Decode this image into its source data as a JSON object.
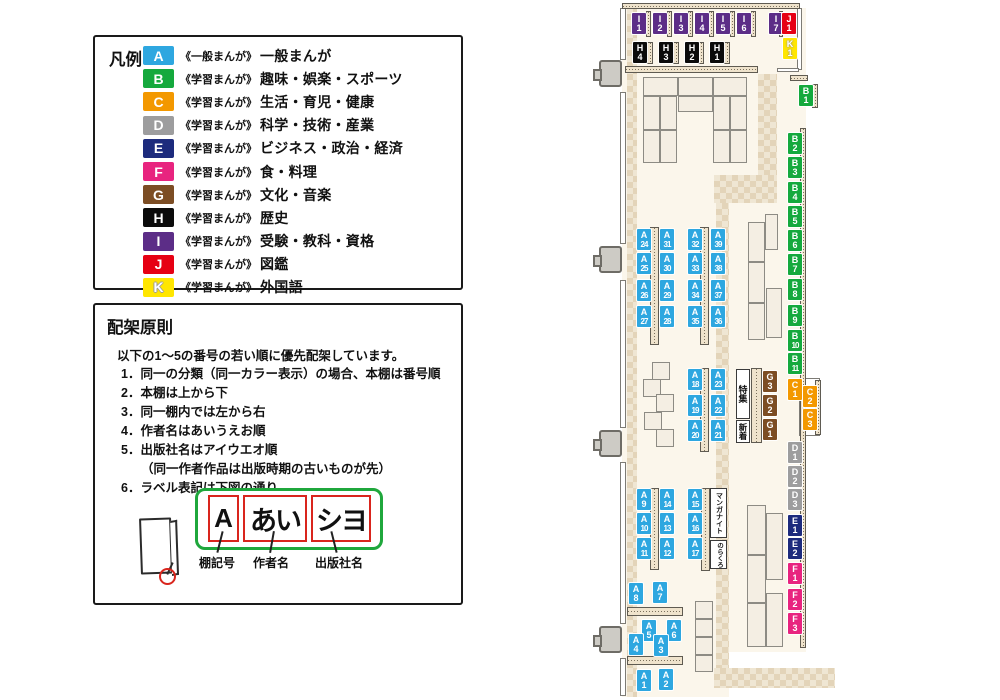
{
  "category_colors": {
    "A": "#2EA7E0",
    "B": "#15A93D",
    "C": "#F39800",
    "D": "#9D9D9E",
    "E": "#1D2B7D",
    "F": "#E8247F",
    "G": "#7C4D24",
    "H": "#0B0B0B",
    "I": "#5C2D87",
    "J": "#E60013",
    "K": "#FFE600"
  },
  "legend": {
    "title": "凡例",
    "items": [
      {
        "code": "A",
        "series": "《一般まんが》",
        "category": "一般まんが"
      },
      {
        "code": "B",
        "series": "《学習まんが》",
        "category": "趣味・娯楽・スポーツ"
      },
      {
        "code": "C",
        "series": "《学習まんが》",
        "category": "生活・育児・健康"
      },
      {
        "code": "D",
        "series": "《学習まんが》",
        "category": "科学・技術・産業"
      },
      {
        "code": "E",
        "series": "《学習まんが》",
        "category": "ビジネス・政治・経済"
      },
      {
        "code": "F",
        "series": "《学習まんが》",
        "category": "食・料理"
      },
      {
        "code": "G",
        "series": "《学習まんが》",
        "category": "文化・音楽"
      },
      {
        "code": "H",
        "series": "《学習まんが》",
        "category": "歴史"
      },
      {
        "code": "I",
        "series": "《学習まんが》",
        "category": "受験・教科・資格"
      },
      {
        "code": "J",
        "series": "《学習まんが》",
        "category": "図鑑"
      },
      {
        "code": "K",
        "series": "《学習まんが》",
        "category": "外国語"
      }
    ]
  },
  "principles": {
    "title": "配架原則",
    "intro": "以下の1～5の番号の若い順に優先配架しています。",
    "items": [
      "1．同一の分類（同一カラー表示）の場合、本棚は番号順",
      "2．本棚は上から下",
      "3．同一棚内では左から右",
      "4．作者名はあいうえお順",
      "5．出版社名はアイウエオ順",
      "（同一作者作品は出版時期の古いものが先）",
      "6．ラベル表記は下図の通り"
    ],
    "label_diagram": {
      "segments": [
        {
          "text": "A",
          "caption": "棚記号"
        },
        {
          "text": "あい",
          "caption": "作者名"
        },
        {
          "text": "シヨ",
          "caption": "出版社名"
        }
      ]
    }
  },
  "map": {
    "feature_boxes": [
      {
        "text": "特集",
        "x": 736,
        "y": 369,
        "w": 14,
        "h": 50
      },
      {
        "text": "新着",
        "x": 736,
        "y": 420,
        "w": 14,
        "h": 23
      },
      {
        "text": "マンガナイト",
        "x": 710,
        "y": 488,
        "w": 17,
        "h": 50
      },
      {
        "text": "のらくろ",
        "x": 710,
        "y": 540,
        "w": 17,
        "h": 29
      }
    ],
    "shelf_labels": [
      {
        "id": "I1",
        "x": 632,
        "y": 13
      },
      {
        "id": "I2",
        "x": 653,
        "y": 13
      },
      {
        "id": "I3",
        "x": 674,
        "y": 13
      },
      {
        "id": "I4",
        "x": 695,
        "y": 13
      },
      {
        "id": "I5",
        "x": 716,
        "y": 13
      },
      {
        "id": "I6",
        "x": 737,
        "y": 13
      },
      {
        "id": "I7",
        "x": 769,
        "y": 13
      },
      {
        "id": "J1",
        "x": 782,
        "y": 13
      },
      {
        "id": "K1",
        "x": 783,
        "y": 38
      },
      {
        "id": "H4",
        "x": 633,
        "y": 42
      },
      {
        "id": "H3",
        "x": 659,
        "y": 42
      },
      {
        "id": "H2",
        "x": 685,
        "y": 42
      },
      {
        "id": "H1",
        "x": 710,
        "y": 42
      },
      {
        "id": "B1",
        "x": 799,
        "y": 85
      },
      {
        "id": "B2",
        "x": 788,
        "y": 133
      },
      {
        "id": "B3",
        "x": 788,
        "y": 157
      },
      {
        "id": "B4",
        "x": 788,
        "y": 182
      },
      {
        "id": "B5",
        "x": 788,
        "y": 206
      },
      {
        "id": "B6",
        "x": 788,
        "y": 230
      },
      {
        "id": "B7",
        "x": 788,
        "y": 254
      },
      {
        "id": "B8",
        "x": 788,
        "y": 279
      },
      {
        "id": "B9",
        "x": 788,
        "y": 305
      },
      {
        "id": "B10",
        "x": 788,
        "y": 330
      },
      {
        "id": "B11",
        "x": 788,
        "y": 353
      },
      {
        "id": "C1",
        "x": 788,
        "y": 379
      },
      {
        "id": "C2",
        "x": 803,
        "y": 386
      },
      {
        "id": "C3",
        "x": 803,
        "y": 409
      },
      {
        "id": "D1",
        "x": 788,
        "y": 442
      },
      {
        "id": "D2",
        "x": 788,
        "y": 466
      },
      {
        "id": "D3",
        "x": 788,
        "y": 489
      },
      {
        "id": "E1",
        "x": 788,
        "y": 515
      },
      {
        "id": "E2",
        "x": 788,
        "y": 538
      },
      {
        "id": "F1",
        "x": 788,
        "y": 563
      },
      {
        "id": "F2",
        "x": 788,
        "y": 589
      },
      {
        "id": "F3",
        "x": 788,
        "y": 613
      },
      {
        "id": "G3",
        "x": 763,
        "y": 371
      },
      {
        "id": "G2",
        "x": 763,
        "y": 395
      },
      {
        "id": "G1",
        "x": 763,
        "y": 419
      },
      {
        "id": "A24",
        "x": 637,
        "y": 229
      },
      {
        "id": "A25",
        "x": 637,
        "y": 253
      },
      {
        "id": "A26",
        "x": 637,
        "y": 280
      },
      {
        "id": "A27",
        "x": 637,
        "y": 306
      },
      {
        "id": "A31",
        "x": 660,
        "y": 229
      },
      {
        "id": "A30",
        "x": 660,
        "y": 253
      },
      {
        "id": "A29",
        "x": 660,
        "y": 280
      },
      {
        "id": "A28",
        "x": 660,
        "y": 306
      },
      {
        "id": "A32",
        "x": 688,
        "y": 229
      },
      {
        "id": "A33",
        "x": 688,
        "y": 253
      },
      {
        "id": "A34",
        "x": 688,
        "y": 280
      },
      {
        "id": "A35",
        "x": 688,
        "y": 306
      },
      {
        "id": "A39",
        "x": 711,
        "y": 229
      },
      {
        "id": "A38",
        "x": 711,
        "y": 253
      },
      {
        "id": "A37",
        "x": 711,
        "y": 280
      },
      {
        "id": "A36",
        "x": 711,
        "y": 306
      },
      {
        "id": "A18",
        "x": 688,
        "y": 369
      },
      {
        "id": "A19",
        "x": 688,
        "y": 395
      },
      {
        "id": "A20",
        "x": 688,
        "y": 420
      },
      {
        "id": "A23",
        "x": 711,
        "y": 369
      },
      {
        "id": "A22",
        "x": 711,
        "y": 395
      },
      {
        "id": "A21",
        "x": 711,
        "y": 420
      },
      {
        "id": "A9",
        "x": 637,
        "y": 489
      },
      {
        "id": "A10",
        "x": 637,
        "y": 513
      },
      {
        "id": "A11",
        "x": 637,
        "y": 538
      },
      {
        "id": "A14",
        "x": 660,
        "y": 489
      },
      {
        "id": "A13",
        "x": 660,
        "y": 513
      },
      {
        "id": "A12",
        "x": 660,
        "y": 538
      },
      {
        "id": "A15",
        "x": 688,
        "y": 489
      },
      {
        "id": "A16",
        "x": 688,
        "y": 513
      },
      {
        "id": "A17",
        "x": 688,
        "y": 538
      },
      {
        "id": "A8",
        "x": 629,
        "y": 583
      },
      {
        "id": "A7",
        "x": 653,
        "y": 582
      },
      {
        "id": "A5",
        "x": 642,
        "y": 620
      },
      {
        "id": "A6",
        "x": 667,
        "y": 620
      },
      {
        "id": "A4",
        "x": 629,
        "y": 634
      },
      {
        "id": "A3",
        "x": 654,
        "y": 635
      },
      {
        "id": "A1",
        "x": 637,
        "y": 670
      },
      {
        "id": "A2",
        "x": 659,
        "y": 669
      }
    ]
  }
}
